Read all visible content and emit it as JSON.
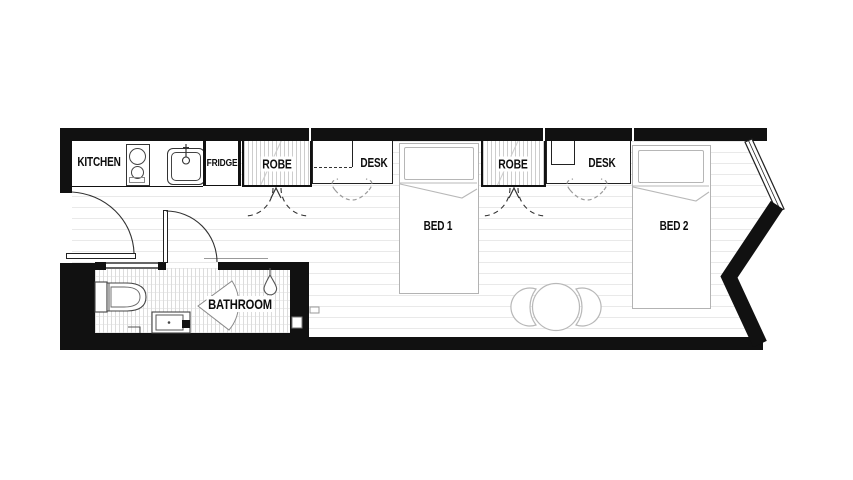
{
  "plan": {
    "labels": {
      "kitchen": "KITCHEN",
      "fridge": "FRIDGE",
      "robe_1": "ROBE",
      "desk_1": "DESK",
      "robe_2": "ROBE",
      "desk_2": "DESK",
      "bed_1": "BED 1",
      "bed_2": "BED 2",
      "bathroom": "BATHROOM"
    },
    "colors": {
      "wall": "#111111",
      "fixture_line": "#3a3a3a",
      "furniture_line": "#b3b3b3",
      "floorboard_line": "#e9e9e9",
      "tile_line": "#dcdcdc",
      "background": "#ffffff"
    }
  }
}
